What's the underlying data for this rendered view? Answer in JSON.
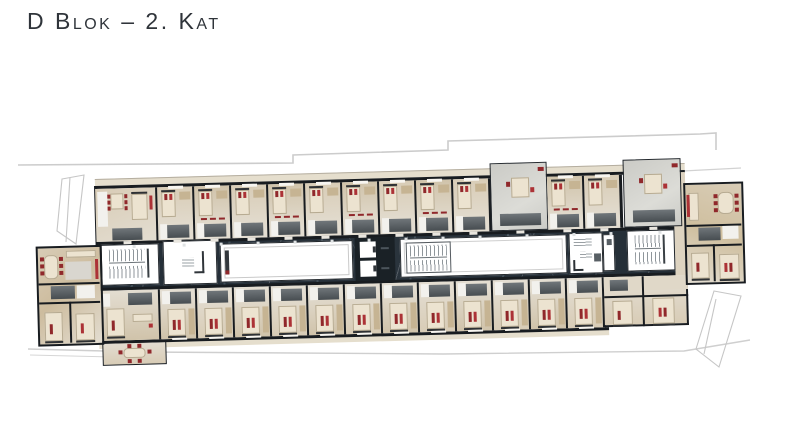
{
  "title": {
    "text": "D Blok – 2. Kat"
  },
  "palette": {
    "background": "#ffffff",
    "title_color": "#2f343a",
    "wall": "#181c20",
    "core_line": "#23282d",
    "corridor": "#2a343d",
    "corridor_deep": "#242e37",
    "room_floor": "#d8ccb6",
    "room_floor_alt": "#d0c3aa",
    "room_floor_cool": "#e3ddd1",
    "terrace_floor": "#cbcbc6",
    "bed": "#ece3d0",
    "bed_border": "#b7ab92",
    "headboard": "#2e3134",
    "pod": "#5f666a",
    "pod_dark": "#474d51",
    "bath": "#f2f1ed",
    "wardrobe": "#c6b493",
    "accent_red": "#90282b",
    "accent_red_bright": "#ac3236",
    "eave": "#e5decd",
    "eave_line": "#b5aea0",
    "site_line": "#cccccc",
    "white": "#ffffff",
    "stair_tread": "#8f969b"
  },
  "plan": {
    "rotation_deg": -1.55,
    "modules": {
      "top_regular": 11,
      "top_terrace": 2,
      "bottom_regular": 12
    },
    "cores": [
      "west-stair-core",
      "corridor-lobby-room",
      "west-atrium-void",
      "elevator-bank",
      "central-void-stair",
      "technical-room",
      "east-stair-core"
    ],
    "units": [
      "west-end-apartment",
      "northwest-corner-unit",
      "southwest-corner-unit",
      "southwest-garden-bay",
      "southeast-apartment",
      "east-end-apartment"
    ]
  }
}
